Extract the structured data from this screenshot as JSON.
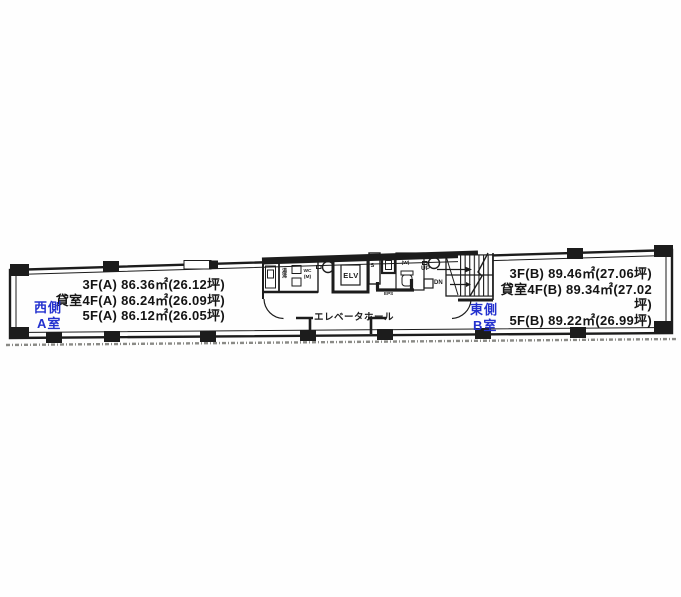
{
  "floor_plan": {
    "west_unit": {
      "side_label": "西側",
      "room_label": "A室",
      "lines": [
        "3F(A) 86.36㎡(26.12坪)",
        "貸室4F(A) 86.24㎡(26.09坪)",
        "5F(A) 86.12㎡(26.05坪)"
      ]
    },
    "east_unit": {
      "side_label": "東側",
      "room_label": "B室",
      "lines": [
        "3F(B) 89.46㎡(27.06坪)",
        "貸室4F(B) 89.34㎡(27.02坪)",
        "5F(B) 89.22㎡(26.99坪)"
      ]
    },
    "core": {
      "elevator": "ELV",
      "hall": "エレベータホール",
      "wc_men": "WC(M)",
      "wc_women": "WC(W)",
      "pipe_shaft": "PS",
      "eps": "EPS",
      "kitchenette": "湯沸",
      "up": "UP",
      "down": "DN"
    },
    "colors": {
      "accent_blue": "#2331cf",
      "ink": "#1c1c1c"
    }
  }
}
